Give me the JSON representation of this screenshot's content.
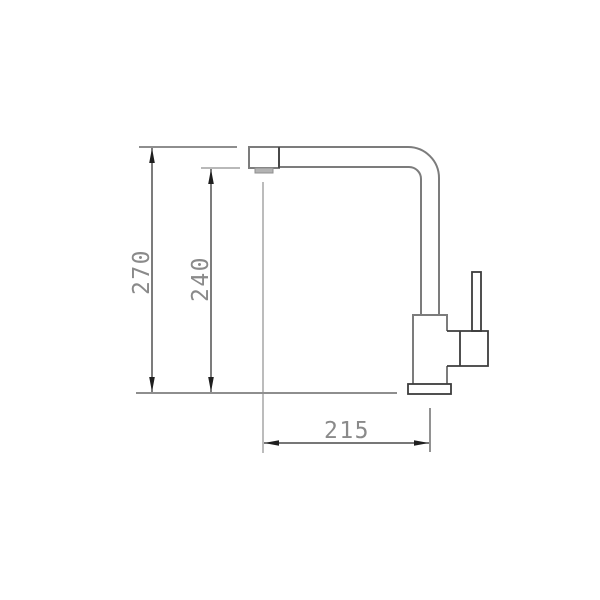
{
  "page": {
    "background": "#ffffff",
    "subject": "kitchen faucet side-elevation technical drawing with dimensions"
  },
  "drawing": {
    "colors": {
      "outline_gray": "#7c7c7c",
      "accent_dark": "#3c3c3c",
      "dimension_line": "#262626",
      "extension_gray": "#8f8f8f",
      "label_text": "#8a8a8a",
      "aerator_fill": "#b3b3b3"
    },
    "dimensions": {
      "overall_height": {
        "label": "270",
        "orientation": "vertical"
      },
      "spout_height": {
        "label": "240",
        "orientation": "vertical"
      },
      "spout_reach": {
        "label": "215",
        "orientation": "horizontal"
      }
    }
  }
}
